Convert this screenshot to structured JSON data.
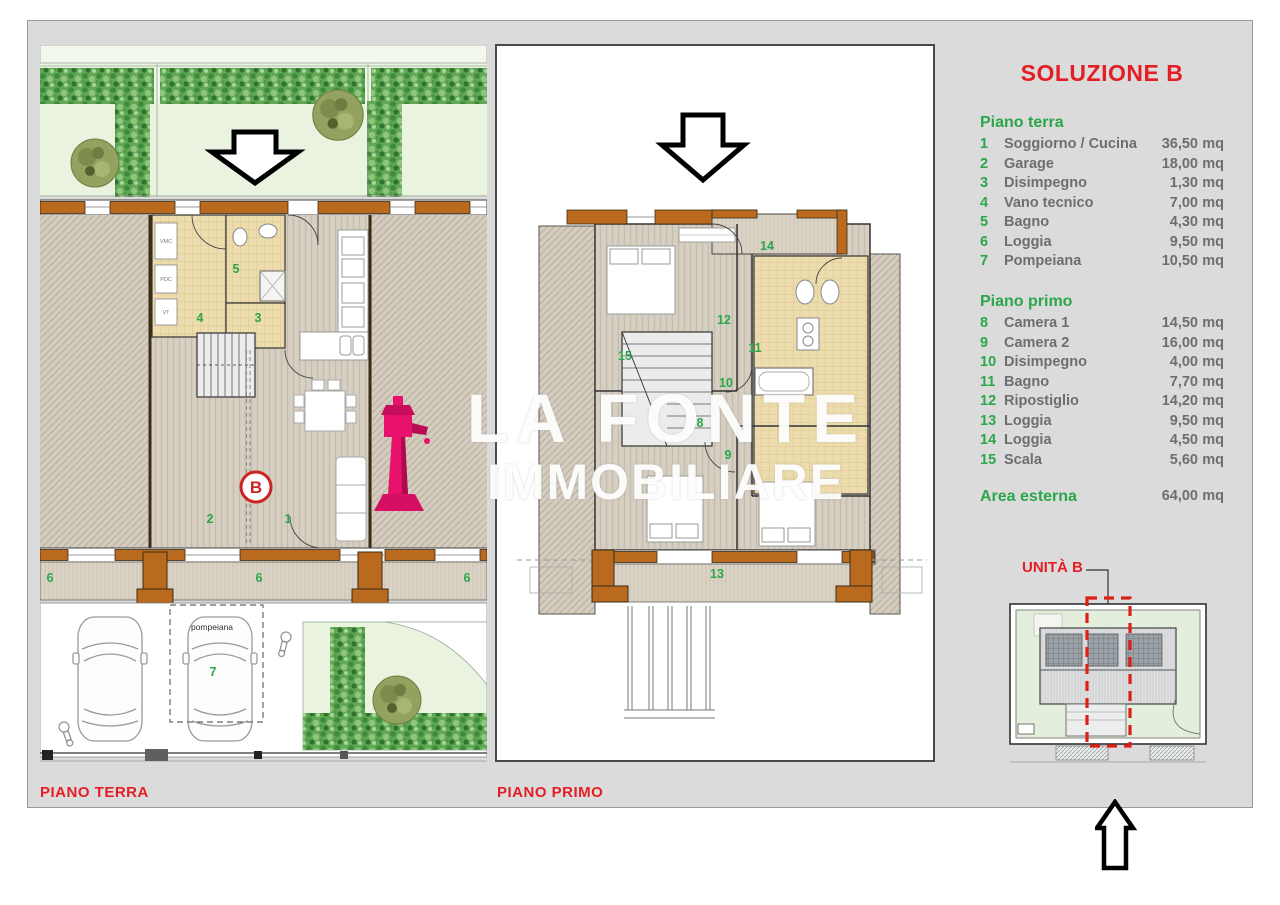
{
  "title": "SOLUZIONE B",
  "legend": {
    "ground": {
      "header": "Piano terra",
      "items": [
        {
          "num": "1",
          "name": "Soggiorno / Cucina",
          "value": "36,50",
          "unit": "mq"
        },
        {
          "num": "2",
          "name": "Garage",
          "value": "18,00",
          "unit": "mq"
        },
        {
          "num": "3",
          "name": "Disimpegno",
          "value": "1,30",
          "unit": "mq"
        },
        {
          "num": "4",
          "name": "Vano tecnico",
          "value": "7,00",
          "unit": "mq"
        },
        {
          "num": "5",
          "name": "Bagno",
          "value": "4,30",
          "unit": "mq"
        },
        {
          "num": "6",
          "name": "Loggia",
          "value": "9,50",
          "unit": "mq"
        },
        {
          "num": "7",
          "name": "Pompeiana",
          "value": "10,50",
          "unit": "mq"
        }
      ]
    },
    "first": {
      "header": "Piano primo",
      "items": [
        {
          "num": "8",
          "name": "Camera 1",
          "value": "14,50",
          "unit": "mq"
        },
        {
          "num": "9",
          "name": "Camera 2",
          "value": "16,00",
          "unit": "mq"
        },
        {
          "num": "10",
          "name": "Disimpegno",
          "value": "4,00",
          "unit": "mq"
        },
        {
          "num": "11",
          "name": "Bagno",
          "value": "7,70",
          "unit": "mq"
        },
        {
          "num": "12",
          "name": "Ripostiglio",
          "value": "14,20",
          "unit": "mq"
        },
        {
          "num": "13",
          "name": "Loggia",
          "value": "9,50",
          "unit": "mq"
        },
        {
          "num": "14",
          "name": "Loggia",
          "value": "4,50",
          "unit": "mq"
        },
        {
          "num": "15",
          "name": "Scala",
          "value": "5,60",
          "unit": "mq"
        }
      ]
    },
    "area": {
      "label": "Area esterna",
      "value": "64,00",
      "unit": "mq"
    }
  },
  "plans": {
    "ground": {
      "caption": "PIANO TERRA",
      "unit_marker": "B",
      "texts": {
        "vmc": "VMC",
        "pdc": "PDC",
        "vt": "VT",
        "pompeiana": "pompeiana"
      },
      "numbers": [
        {
          "label": "5",
          "x": 196,
          "y": 224
        },
        {
          "label": "4",
          "x": 160,
          "y": 273
        },
        {
          "label": "3",
          "x": 218,
          "y": 273
        },
        {
          "label": "2",
          "x": 170,
          "y": 474
        },
        {
          "label": "1",
          "x": 248,
          "y": 474
        },
        {
          "label": "6",
          "x": 10,
          "y": 533
        },
        {
          "label": "6",
          "x": 219,
          "y": 533
        },
        {
          "label": "6",
          "x": 427,
          "y": 533
        },
        {
          "label": "7",
          "x": 173,
          "y": 627
        }
      ]
    },
    "first": {
      "caption": "PIANO PRIMO",
      "numbers": [
        {
          "label": "14",
          "x": 270,
          "y": 200
        },
        {
          "label": "12",
          "x": 227,
          "y": 274
        },
        {
          "label": "15",
          "x": 128,
          "y": 310
        },
        {
          "label": "11",
          "x": 258,
          "y": 302
        },
        {
          "label": "10",
          "x": 229,
          "y": 337
        },
        {
          "label": "8",
          "x": 203,
          "y": 377
        },
        {
          "label": "9",
          "x": 231,
          "y": 409
        },
        {
          "label": "13",
          "x": 220,
          "y": 528
        }
      ]
    }
  },
  "unit_map": {
    "label": "UNITÀ B"
  },
  "watermark": {
    "line1": "LA FONTE",
    "line2": "IMMOBILIARE"
  },
  "colors": {
    "accent_red": "#e31e24",
    "accent_green": "#2ca64b",
    "wall_brown": "#b96a1f",
    "logo_magenta": "#e8126d",
    "panel_gray": "#dbdbdb",
    "hedge_green": "#61a854"
  }
}
